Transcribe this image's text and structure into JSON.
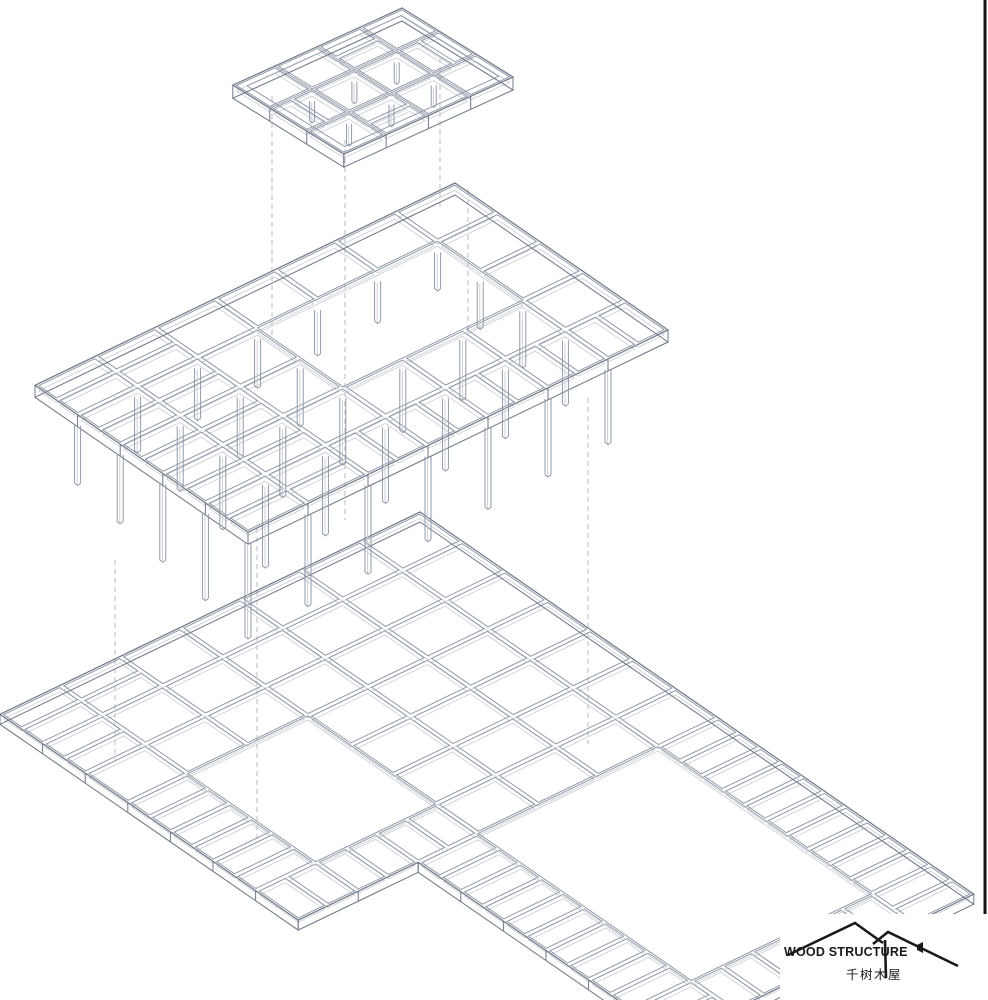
{
  "logo": {
    "line1": "WOOD STRUCTURE",
    "line2": "千树木屋",
    "color": "#1a1a1a",
    "icon": "house-roofs"
  },
  "drawing": {
    "background": "#ffffff",
    "colors": {
      "main": "#8c96a4",
      "light": "#c7ccd4",
      "outline": "#707a88",
      "dash": "#b6bcc5",
      "edge": "#151515"
    },
    "edge_line": {
      "x": 985,
      "y1": 0,
      "y2": 922,
      "width": 3
    },
    "dashed_guides": [
      {
        "x": 272,
        "y1": 96,
        "y2": 335
      },
      {
        "x": 345,
        "y1": 140,
        "y2": 520
      },
      {
        "x": 440,
        "y1": 58,
        "y2": 210
      },
      {
        "x": 468,
        "y1": 190,
        "y2": 332
      },
      {
        "x": 115,
        "y1": 560,
        "y2": 760
      },
      {
        "x": 257,
        "y1": 528,
        "y2": 840
      },
      {
        "x": 588,
        "y1": 398,
        "y2": 744
      }
    ],
    "levels": [
      {
        "name": "ground-floor-platform",
        "origin": [
          420,
          512
        ],
        "u": [
          42.6,
          29.4
        ],
        "v": [
          -60,
          28.9
        ],
        "nu": 13,
        "nv": 9,
        "depth": 10,
        "inset": 2.2,
        "rects": [
          {
            "i0": 0,
            "j0": 0,
            "iw": 7,
            "jw": 7
          },
          {
            "i0": 7,
            "j0": 0,
            "iw": 6,
            "jw": 5
          }
        ],
        "outline": [
          [
            0,
            0
          ],
          [
            13,
            0
          ],
          [
            13,
            5
          ],
          [
            7,
            5
          ],
          [
            7,
            7
          ],
          [
            0,
            7
          ]
        ],
        "skip_segments": [
          0,
          5
        ],
        "voids": [
          {
            "i0": 3,
            "j0": 4,
            "iw": 3,
            "jw": 2
          },
          {
            "i0": 7,
            "j0": 1,
            "iw": 5,
            "jw": 3
          }
        ],
        "splits_u": [
          [
            0,
            5
          ],
          [
            0,
            6
          ],
          [
            1,
            6
          ],
          [
            3,
            6
          ],
          [
            4,
            6
          ],
          [
            5,
            6
          ],
          [
            7,
            0
          ],
          [
            8,
            0
          ],
          [
            9,
            0
          ],
          [
            10,
            0
          ],
          [
            11,
            0
          ],
          [
            12,
            0
          ],
          [
            7,
            4
          ],
          [
            8,
            4
          ],
          [
            9,
            4
          ],
          [
            10,
            4
          ],
          [
            11,
            4
          ],
          [
            12,
            4
          ]
        ],
        "splits_v": [
          [
            6,
            4
          ],
          [
            6,
            5
          ],
          [
            6,
            6
          ],
          [
            12,
            1
          ],
          [
            12,
            2
          ],
          [
            12,
            3
          ]
        ],
        "columns": null
      },
      {
        "name": "upper-floor-frame",
        "origin": [
          455,
          183
        ],
        "u": [
          42.6,
          29.4
        ],
        "v": [
          -60,
          28.9
        ],
        "nu": 5,
        "nv": 7,
        "depth": 12,
        "inset": 2.2,
        "voids": [
          {
            "i0": 1,
            "j0": 1,
            "iw": 2,
            "jw": 3
          }
        ],
        "splits_u": [
          [
            0,
            5
          ],
          [
            1,
            5
          ],
          [
            2,
            5
          ],
          [
            3,
            5
          ],
          [
            4,
            5
          ],
          [
            0,
            6
          ],
          [
            1,
            6
          ],
          [
            2,
            6
          ],
          [
            3,
            6
          ],
          [
            4,
            6
          ]
        ],
        "splits_v": [
          [
            4,
            0
          ],
          [
            4,
            1
          ],
          [
            4,
            2
          ],
          [
            4,
            3
          ],
          [
            4,
            4
          ]
        ],
        "columns": {
          "auto": {
            "i0": 1,
            "i1": 5,
            "j0": 1,
            "j1": 7,
            "exclude_void": true
          },
          "len_base": 24,
          "len_i": 9,
          "len_j": 3.5,
          "w": 6
        }
      },
      {
        "name": "roof-frame",
        "origin": [
          402,
          8
        ],
        "u": [
          37,
          23
        ],
        "v": [
          -42.3,
          19.3
        ],
        "nu": 3,
        "nv": 4,
        "depth": 13,
        "inset": 2.0,
        "band": 0.18,
        "full_grid": true,
        "voids": [],
        "splits_u": [
          [
            0,
            1
          ],
          [
            2,
            2
          ]
        ],
        "splits_v": [
          [
            1,
            0
          ],
          [
            1,
            3
          ]
        ],
        "columns": {
          "nodes": [
            [
              1,
              1
            ],
            [
              1,
              2
            ],
            [
              1,
              3
            ],
            [
              2,
              1
            ],
            [
              2,
              2
            ],
            [
              2,
              3
            ]
          ],
          "len": 20,
          "w": 5
        }
      }
    ]
  }
}
